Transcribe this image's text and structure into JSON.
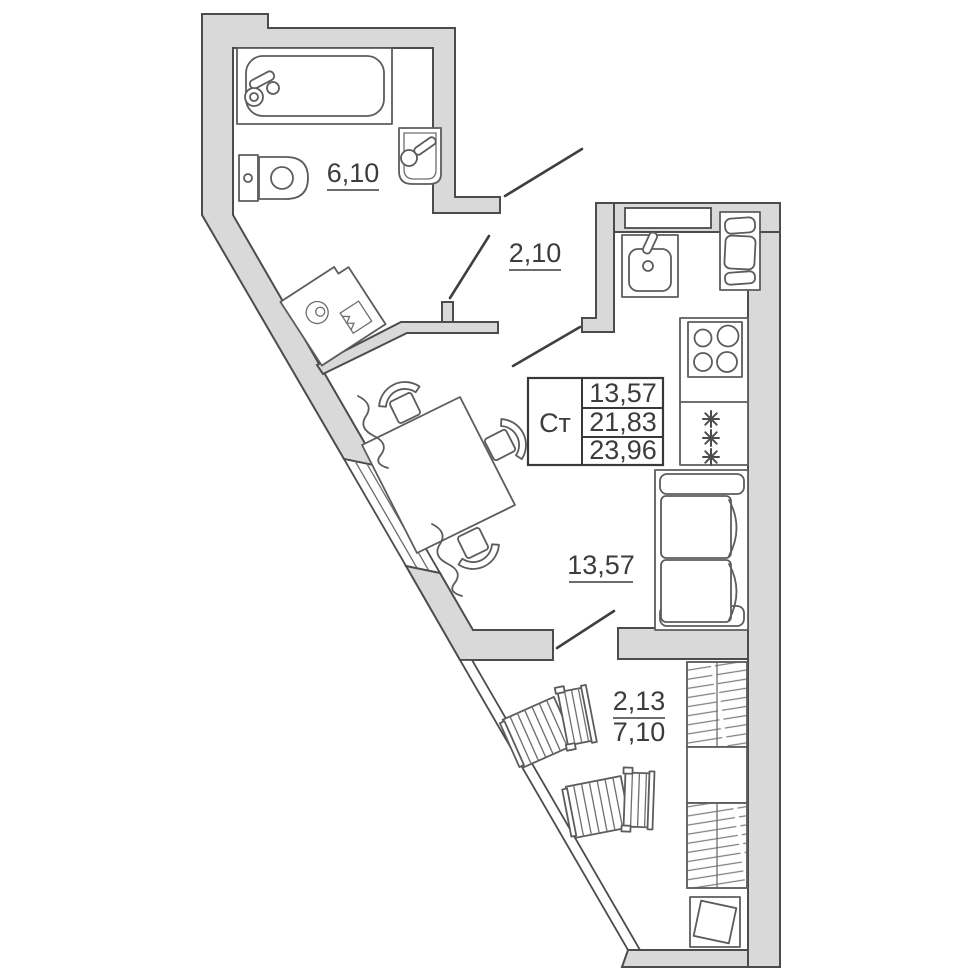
{
  "plan": {
    "rooms": {
      "bathroom": {
        "area_label": "6,10"
      },
      "hall": {
        "area_label": "2,10"
      },
      "living": {
        "area_label": "13,57"
      },
      "corridor": {
        "upper_label": "2,13",
        "lower_label": "7,10"
      }
    },
    "legend": {
      "type_label": "Ст",
      "rows": [
        "13,57",
        "21,83",
        "23,96"
      ]
    },
    "colors": {
      "wall_fill": "#d9d9d9",
      "wall_stroke": "#4c4c4c",
      "fixture_stroke": "#5c5c5c",
      "text": "#3c3c3c",
      "background": "#ffffff"
    }
  }
}
